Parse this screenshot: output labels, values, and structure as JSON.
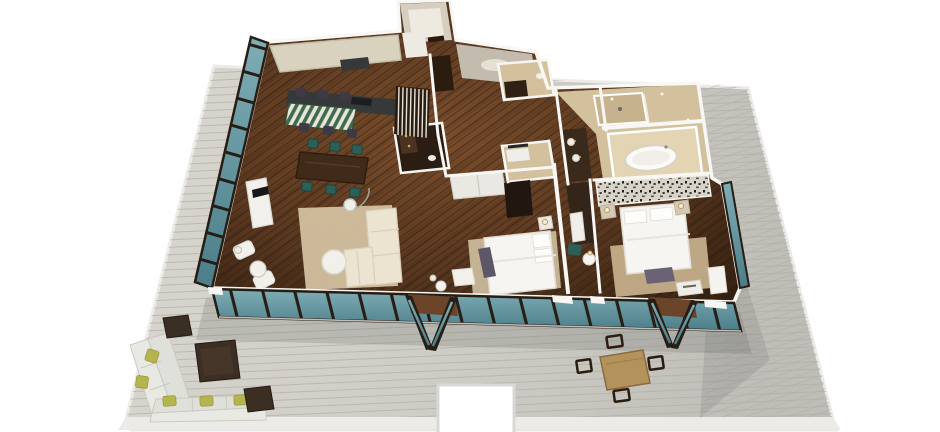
{
  "scene": {
    "title": "3D isometric floor plan render of a three-bedroom suite with wraparound terrace deck",
    "style": "photoreal architectural 3D floor plan, white background"
  },
  "colors": {
    "deck": "#cdccc5",
    "deck_light": "#d8d6cf",
    "deck_right": "#bfbdb7",
    "deck_gap": "#b0aea7",
    "fascia": "#ecebe8",
    "shadow": "rgba(100,104,100,0.22)",
    "floor_light": "#7b4e2c",
    "floor_mid": "#5a3820",
    "floor_dark": "#33200f",
    "plank_gap": "#2b1a0c",
    "wall": "#f8f7f4",
    "frame": "#261d15",
    "glass_light": "#7fadb5",
    "glass_dark": "#4b7e89",
    "cabinet": "#d9d2bf",
    "counter_dark": "#35393a",
    "bar_green": "#3f6b50",
    "bar_cream": "#e7e5d7",
    "stool": "#3f3947",
    "dining_table": "#402b1b",
    "chair_teal": "#2c5f58",
    "sofa": "#ece3d0",
    "rug_living": "#d8c8a6",
    "white_furniture": "#f2f0eb",
    "bed_white": "#f7f5f1",
    "bed_edge": "#e2ddd3",
    "rug_bed": "#d7c9a8",
    "rug_master": "#ccb590",
    "bench_gray": "#5d5666",
    "bench_master": "#6b6375",
    "tile": "#d3c19d",
    "tile_dark": "#c6b28c",
    "tile_light": "#e3d5b4",
    "vanity_dark": "#3a2a1b",
    "wood_dark": "#2e2013",
    "speckle_bg": "#d8d3c9",
    "speckle_dot": "#211d18",
    "outdoor_cushion": "#e9e9e4",
    "pillow_green": "#b5b54f",
    "wicker": "#3b2e22",
    "patio_table": "#b3925c",
    "patio_chair": "#2a1c0f",
    "gold": "#d0a94a",
    "tub_white": "#fbfaf7"
  },
  "rooms": [
    {
      "name": "kitchen",
      "features": [
        "cream cabinetry",
        "dark island with cooktop",
        "green striped breakfast bar",
        "six bar stools"
      ]
    },
    {
      "name": "dining-area",
      "features": [
        "dark wood table",
        "six teal chairs"
      ]
    },
    {
      "name": "living-area",
      "features": [
        "cream sectional sofa",
        "round white coffee table",
        "arc floor lamp",
        "area rug",
        "media console with TV",
        "two white armchairs"
      ]
    },
    {
      "name": "entry-foyer",
      "features": [
        "vestibule",
        "slatted wood screen",
        "dark wardrobe"
      ]
    },
    {
      "name": "powder-room",
      "features": [
        "dark stone floor",
        "gold sconces"
      ]
    },
    {
      "name": "guest-bathroom",
      "features": [
        "beige tile",
        "dark vanity"
      ]
    },
    {
      "name": "second-bedroom",
      "features": [
        "white queen bed",
        "closet",
        "nightstand",
        "upholstered bench"
      ]
    },
    {
      "name": "master-bedroom",
      "features": [
        "white king bed",
        "patterned headboard wall",
        "tan rug",
        "bench",
        "nightstands with lamps",
        "teal accent chair"
      ]
    },
    {
      "name": "master-bathroom",
      "features": [
        "freestanding oval tub",
        "walk-in shower",
        "dark double vanity",
        "travertine tile"
      ]
    },
    {
      "name": "terrace-deck",
      "features": [
        "gray plank decking",
        "wraparound layout",
        "stair notch"
      ]
    },
    {
      "name": "outdoor-lounge",
      "features": [
        "L-shaped sofa",
        "chartreuse pillows",
        "three wicker ottomans"
      ]
    },
    {
      "name": "outdoor-dining",
      "features": [
        "square wood table",
        "four metal chairs"
      ]
    }
  ],
  "glazing": {
    "left_wall": "floor-to-ceiling windows",
    "front_wall": "floor-to-ceiling windows with two open french-door sets",
    "glass_tint": "teal"
  }
}
